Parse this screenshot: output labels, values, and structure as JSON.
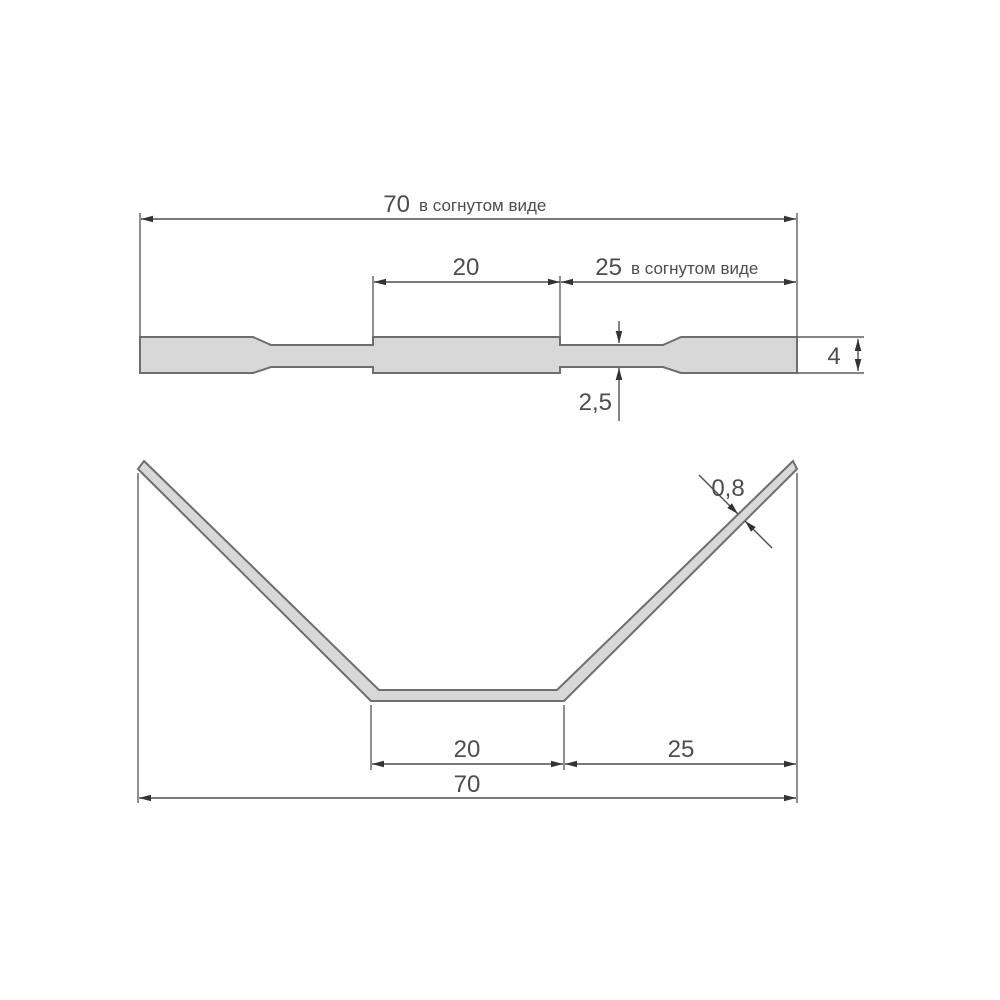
{
  "page": {
    "background": "#ffffff"
  },
  "drawing": {
    "type": "technical-dimension-drawing",
    "language": "ru",
    "colors": {
      "part_fill": "#d8d8d8",
      "part_outline": "#6e6e6e",
      "dimension_lines": "#4f4f4f",
      "text": "#4d4d4d",
      "arrows": "#333333"
    },
    "flat_view": {
      "description": "flat strip profile (before bending)",
      "overall_length": {
        "value": "70",
        "note": "в согнутом виде"
      },
      "middle_section_length": {
        "value": "20"
      },
      "right_section_length": {
        "value": "25",
        "note": "в согнутом виде"
      },
      "thin_section_height": {
        "value": "2,5"
      },
      "end_height": {
        "value": "4"
      }
    },
    "bent_view": {
      "description": "strip bent into V shape",
      "material_thickness": {
        "value": "0,8"
      },
      "bottom_section_length": {
        "value": "20"
      },
      "right_projection_length": {
        "value": "25"
      },
      "overall_width": {
        "value": "70"
      }
    }
  }
}
